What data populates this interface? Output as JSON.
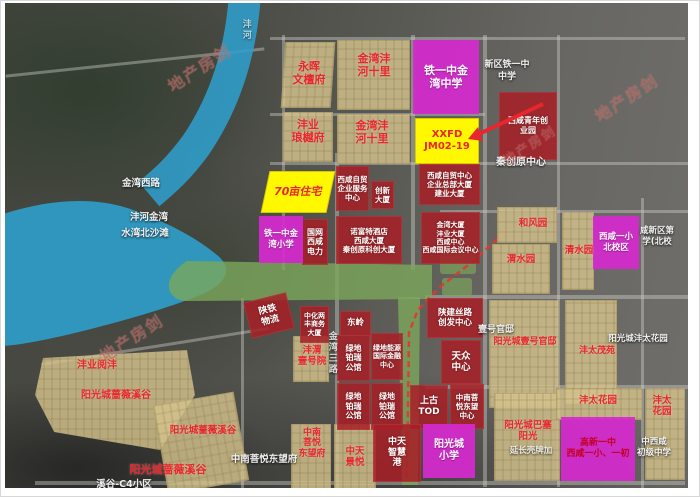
{
  "watermark": "地产房剑",
  "water": {
    "river_name": "沣河",
    "bay_name": "沣河金湾",
    "beach_name": "水湾北沙滩"
  },
  "roads": {
    "jinwan_west_rd": "金湾西路",
    "jinwan_third_rd": "金湾三路"
  },
  "parcels_yellow": {
    "residential_70mu": "70亩住宅",
    "plot_code": "XXFD\nJM02-19"
  },
  "schools": {
    "tieyizhong_middle": "铁一中金\n湾中学",
    "tieyizhong_primary": "铁一中金\n湾小学",
    "xixian_primary_north": "西咸一小\n北校区",
    "yangguangcheng_primary": "阳光城\n小学",
    "gaoxin_combo": "高新一中\n西咸一小、一初"
  },
  "red_blocks": {
    "youth_park": "西咸青年创\n业园",
    "zimao_service": "西咸自贸\n企业服务\n中心",
    "chuangxin_tower": "创新\n大厦",
    "zimao_center": "西咸自贸中心\n企业总部大厦\n建业大厦",
    "guowang_power": "国网\n西咸\n电力",
    "novotel_cluster": "诺富特酒店\n西咸大厦\n秦创原科创大厦",
    "jinwan_tower_cluster": "金湾大厦\n沣业大厦\n西咸中心\n西咸国际会议中心",
    "shantie_logistics": "陕铁\n物流",
    "zhonghua_tower": "中化两\n丰商务\n大厦",
    "dongling": "东岭",
    "lvdi_borui": "绿地\n铂瑞\n公馆",
    "lvdi_energy": "绿地能源\n国际金融\n中心",
    "shaanjian_silkroad": "陕建丝路\n创发中心",
    "tianzhong_center": "天众\n中心",
    "shanggu_tod": "上古\nTOD",
    "zhongnan_center": "中南菩\n悦东望\n中心",
    "zhongtian_port": "中天\n智慧\n港"
  },
  "tan_labels": {
    "yonghui": "永晖\n文檀府",
    "jinwan_shili": "金湾沣\n河十里",
    "fengye_langyue": "沣业\n琅樾府",
    "hefeng_garden": "和风园",
    "weishui_garden": "渭水园",
    "qingshui_garden": "清水园",
    "fengye_yuefeng": "沣业阅沣",
    "qiangwei_valley": "阳光城蔷薇溪谷",
    "fengwei_yihao": "沣渭\n壹号院",
    "zhongnan_fu": "中南\n菩悦\n东望府",
    "zhongtian_jingyue": "中天\n景悦",
    "yihao_guandi_project": "阳光城壹号官邸",
    "futai_maoyuan": "沣太茂苑",
    "basai_sunshine": "阳光城巴塞\n阳光",
    "futai_garden": "沣太花园",
    "futai_garden_2line": "沣太\n花园"
  },
  "map_labels": {
    "qinchuangyuan_center": "秦创原中心",
    "tieyi_frag": "新区铁一中\n中学",
    "yihao_guandi": "壹号官邸",
    "yangguang_futai_garden": "阳光城沣太花园",
    "xixiao_north_frag": "咸新区第\n学(北校",
    "chuji_middle_frag": "中西咸\n初级中学",
    "shell_station": "延长壳牌加",
    "zhongnan_dongwangfu": "中南菩悦东望府",
    "xigu_c4": "溪谷-C4小区"
  }
}
